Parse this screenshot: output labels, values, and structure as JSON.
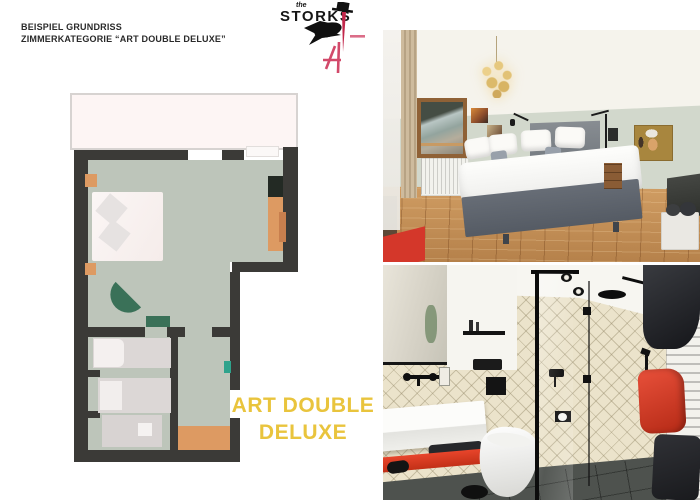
{
  "header": {
    "line1": "BEISPIEL GRUNDRISS",
    "line2": "ZIMMERKATEGORIE “ART DOUBLE DELUXE”"
  },
  "logo": {
    "prefix": "the",
    "name": "STORKS"
  },
  "caption": {
    "line1": "ART DOUBLE",
    "line2": "DELUXE"
  },
  "palette": {
    "caption_yellow": "#e9c43d",
    "plan_wall": "#3b3a37",
    "plan_floor": "#bdc5ba",
    "plan_balcony": "#fdf5f4",
    "plan_bed": "#f8f1f0",
    "plan_furniture_orange": "#dd9a62",
    "plan_furniture_green": "#3a7158",
    "plan_accent_teal": "#2fa38c",
    "logo_pink": "#d2496a",
    "photo_accent_red": "#d8402a"
  }
}
